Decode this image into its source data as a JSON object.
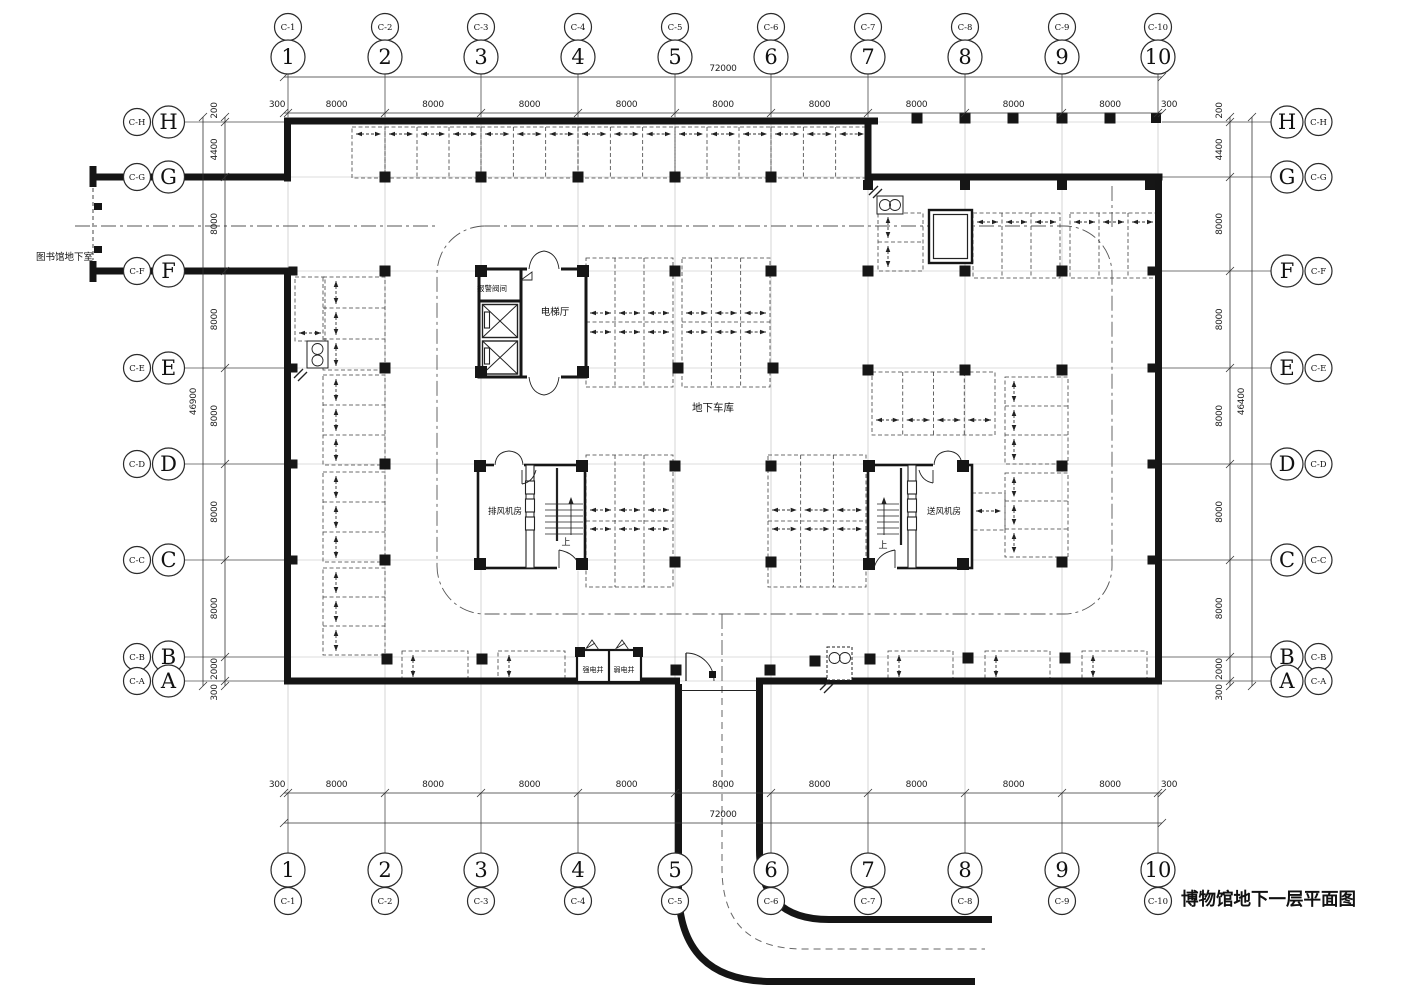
{
  "title": "博物馆地下一层平面图",
  "labels": {
    "library": "图书馆地下室",
    "garage": "地下车库",
    "elevator_hall": "电梯厅",
    "alarm_valve": "报警阀间",
    "exhaust_fan": "排风机房",
    "supply_fan": "送风机房",
    "strong_elec": "强电井",
    "weak_elec": "弱电井",
    "up": "上"
  },
  "grid": {
    "cols": [
      {
        "num": "1",
        "sub": "C-1",
        "x": 288
      },
      {
        "num": "2",
        "sub": "C-2",
        "x": 385
      },
      {
        "num": "3",
        "sub": "C-3",
        "x": 481
      },
      {
        "num": "4",
        "sub": "C-4",
        "x": 578
      },
      {
        "num": "5",
        "sub": "C-5",
        "x": 675
      },
      {
        "num": "6",
        "sub": "C-6",
        "x": 771
      },
      {
        "num": "7",
        "sub": "C-7",
        "x": 868
      },
      {
        "num": "8",
        "sub": "C-8",
        "x": 965
      },
      {
        "num": "9",
        "sub": "C-9",
        "x": 1062
      },
      {
        "num": "10",
        "sub": "C-10",
        "x": 1158
      }
    ],
    "rows": [
      {
        "letter": "H",
        "sub": "C-H",
        "y": 122
      },
      {
        "letter": "G",
        "sub": "C-G",
        "y": 177
      },
      {
        "letter": "F",
        "sub": "C-F",
        "y": 271
      },
      {
        "letter": "E",
        "sub": "C-E",
        "y": 368
      },
      {
        "letter": "D",
        "sub": "C-D",
        "y": 464
      },
      {
        "letter": "C",
        "sub": "C-C",
        "y": 560
      },
      {
        "letter": "B",
        "sub": "C-B",
        "y": 657
      },
      {
        "letter": "A",
        "sub": "C-A",
        "y": 681
      }
    ]
  },
  "dims": {
    "top": {
      "overall": "72000",
      "segs": [
        "300",
        "8000",
        "8000",
        "8000",
        "8000",
        "8000",
        "8000",
        "8000",
        "8000",
        "8000",
        "300"
      ]
    },
    "bottom": {
      "overall": "72000",
      "segs": [
        "300",
        "8000",
        "8000",
        "8000",
        "8000",
        "8000",
        "8000",
        "8000",
        "8000",
        "8000",
        "300"
      ]
    },
    "left": {
      "overall": "46900",
      "segs": [
        "200",
        "4400",
        "8000",
        "8000",
        "8000",
        "8000",
        "8000",
        "2000",
        "300"
      ]
    },
    "right": {
      "overall": "46400",
      "segs": [
        "200",
        "4400",
        "8000",
        "8000",
        "8000",
        "8000",
        "8000",
        "2000",
        "300"
      ]
    }
  },
  "stalls": [
    {
      "x": 352,
      "y": 127,
      "w": 33,
      "h": 51,
      "n": 1,
      "dir": "h",
      "ay": 134
    },
    {
      "x": 385,
      "y": 127,
      "w": 96,
      "h": 51,
      "n": 3,
      "dir": "h",
      "ay": 134
    },
    {
      "x": 481,
      "y": 127,
      "w": 97,
      "h": 51,
      "n": 3,
      "dir": "h",
      "ay": 134
    },
    {
      "x": 578,
      "y": 127,
      "w": 97,
      "h": 51,
      "n": 3,
      "dir": "h",
      "ay": 134
    },
    {
      "x": 675,
      "y": 127,
      "w": 96,
      "h": 51,
      "n": 3,
      "dir": "h",
      "ay": 134
    },
    {
      "x": 771,
      "y": 127,
      "w": 97,
      "h": 51,
      "n": 3,
      "dir": "h",
      "ay": 134
    },
    {
      "x": 878,
      "y": 213,
      "w": 45,
      "h": 58,
      "n": 2,
      "dir": "v",
      "ax": 888
    },
    {
      "x": 973,
      "y": 213,
      "w": 87,
      "h": 65,
      "n": 3,
      "dir": "h",
      "ay": 222
    },
    {
      "x": 1070,
      "y": 213,
      "w": 87,
      "h": 65,
      "n": 3,
      "dir": "h",
      "ay": 222
    },
    {
      "x": 586,
      "y": 258,
      "w": 87,
      "h": 129,
      "n": 3,
      "dir": "h2",
      "ay": 313,
      "ay2": 332,
      "mid": 322
    },
    {
      "x": 682,
      "y": 258,
      "w": 88,
      "h": 129,
      "n": 3,
      "dir": "h2",
      "ay": 313,
      "ay2": 332,
      "mid": 322
    },
    {
      "x": 586,
      "y": 455,
      "w": 87,
      "h": 132,
      "n": 3,
      "dir": "h2",
      "ay": 510,
      "ay2": 529,
      "mid": 521
    },
    {
      "x": 768,
      "y": 455,
      "w": 98,
      "h": 132,
      "n": 3,
      "dir": "h2",
      "ay": 510,
      "ay2": 529,
      "mid": 521
    },
    {
      "x": 872,
      "y": 372,
      "w": 123,
      "h": 63,
      "n": 4,
      "dir": "h",
      "ay": 420
    },
    {
      "x": 1005,
      "y": 377,
      "w": 63,
      "h": 87,
      "n": 3,
      "dir": "v",
      "ax": 1014
    },
    {
      "x": 1005,
      "y": 473,
      "w": 63,
      "h": 84,
      "n": 3,
      "dir": "v",
      "ax": 1014
    },
    {
      "x": 972,
      "y": 493,
      "w": 33,
      "h": 37,
      "n": 1,
      "dir": "h",
      "ay": 511
    },
    {
      "x": 323,
      "y": 277,
      "w": 62,
      "h": 93,
      "n": 3,
      "dir": "v",
      "ax": 336
    },
    {
      "x": 323,
      "y": 375,
      "w": 62,
      "h": 90,
      "n": 3,
      "dir": "v",
      "ax": 336
    },
    {
      "x": 323,
      "y": 472,
      "w": 62,
      "h": 90,
      "n": 3,
      "dir": "v",
      "ax": 336
    },
    {
      "x": 323,
      "y": 568,
      "w": 62,
      "h": 87,
      "n": 3,
      "dir": "v",
      "ax": 336
    },
    {
      "x": 295,
      "y": 277,
      "w": 30,
      "h": 64,
      "n": 1,
      "dir": "h",
      "ay": 333
    },
    {
      "x": 402,
      "y": 651,
      "w": 66,
      "h": 30,
      "n": 1,
      "dir": "v",
      "ax": 413
    },
    {
      "x": 498,
      "y": 651,
      "w": 67,
      "h": 30,
      "n": 1,
      "dir": "v",
      "ax": 509
    },
    {
      "x": 888,
      "y": 651,
      "w": 65,
      "h": 30,
      "n": 1,
      "dir": "v",
      "ax": 899
    },
    {
      "x": 985,
      "y": 651,
      "w": 65,
      "h": 30,
      "n": 1,
      "dir": "v",
      "ax": 996
    },
    {
      "x": 1082,
      "y": 651,
      "w": 65,
      "h": 30,
      "n": 1,
      "dir": "v",
      "ax": 1093
    }
  ],
  "columns": [
    [
      917,
      118
    ],
    [
      965,
      118
    ],
    [
      1013,
      118
    ],
    [
      1062,
      118
    ],
    [
      1110,
      118
    ],
    [
      1156,
      118,
      10
    ],
    [
      385,
      177
    ],
    [
      481,
      177
    ],
    [
      578,
      177
    ],
    [
      675,
      177
    ],
    [
      771,
      177
    ],
    [
      868,
      185,
      10
    ],
    [
      965,
      185,
      10
    ],
    [
      1062,
      185,
      10
    ],
    [
      1150,
      185,
      10
    ],
    [
      385,
      271
    ],
    [
      675,
      271
    ],
    [
      771,
      271
    ],
    [
      868,
      271
    ],
    [
      965,
      271
    ],
    [
      1062,
      271
    ],
    [
      481,
      271,
      12
    ],
    [
      583,
      271,
      12
    ],
    [
      293,
      271,
      9
    ],
    [
      1152,
      271,
      9
    ],
    [
      385,
      368
    ],
    [
      678,
      368
    ],
    [
      773,
      368
    ],
    [
      868,
      370
    ],
    [
      965,
      370
    ],
    [
      1062,
      370
    ],
    [
      481,
      372,
      12
    ],
    [
      583,
      372,
      12
    ],
    [
      293,
      368,
      9
    ],
    [
      1152,
      368,
      9
    ],
    [
      385,
      464
    ],
    [
      675,
      466
    ],
    [
      771,
      466
    ],
    [
      480,
      466,
      12
    ],
    [
      582,
      466,
      12
    ],
    [
      869,
      466,
      12
    ],
    [
      963,
      466,
      12
    ],
    [
      1062,
      466
    ],
    [
      293,
      464,
      9
    ],
    [
      1152,
      464,
      9
    ],
    [
      385,
      560
    ],
    [
      675,
      562
    ],
    [
      771,
      562
    ],
    [
      480,
      564,
      12
    ],
    [
      582,
      564,
      12
    ],
    [
      869,
      564,
      12
    ],
    [
      963,
      564,
      12
    ],
    [
      1062,
      562
    ],
    [
      293,
      560,
      9
    ],
    [
      1152,
      560,
      9
    ],
    [
      387,
      659
    ],
    [
      482,
      659
    ],
    [
      815,
      661
    ],
    [
      870,
      659
    ],
    [
      968,
      658
    ],
    [
      1065,
      658
    ],
    [
      676,
      670
    ],
    [
      770,
      670
    ],
    [
      580,
      652,
      10
    ],
    [
      638,
      652,
      10
    ]
  ],
  "equipment": [
    {
      "x": 307,
      "y": 341,
      "w": 21,
      "h": 27,
      "c": [
        [
          10.5,
          8
        ],
        [
          10.5,
          19.5
        ]
      ]
    },
    {
      "x": 877,
      "y": 196,
      "w": 26,
      "h": 18,
      "c": [
        [
          8,
          9
        ],
        [
          18,
          9
        ]
      ]
    },
    {
      "x": 827,
      "y": 647,
      "w": 25,
      "h": 33,
      "c": [
        [
          7.5,
          11
        ],
        [
          18,
          11
        ]
      ],
      "dash": true
    }
  ],
  "hatches": [
    [
      294,
      369
    ],
    [
      869,
      186
    ],
    [
      820,
      681
    ]
  ]
}
